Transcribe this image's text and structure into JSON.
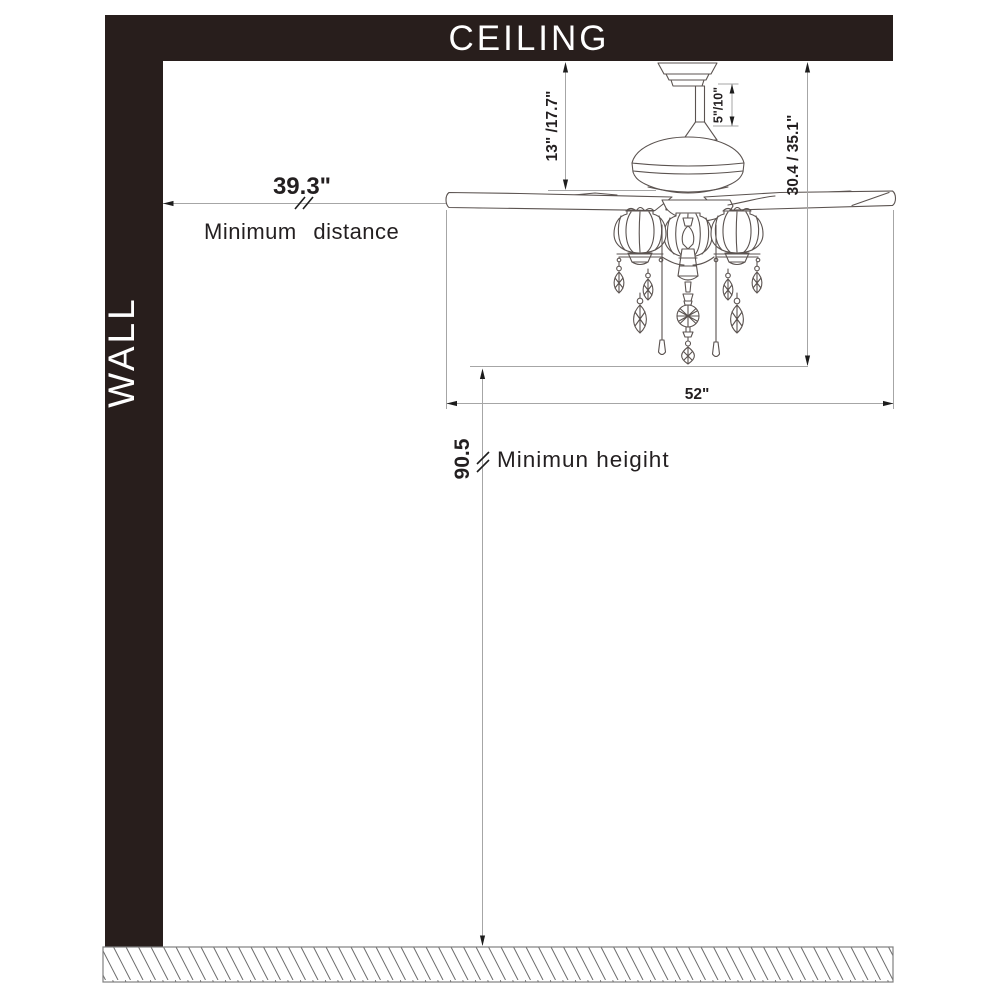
{
  "labels": {
    "ceiling": "CEILING",
    "wall": "WALL"
  },
  "dimensions": {
    "min_distance_value": "39.3\"",
    "min_distance_label": "Minimum distance",
    "ceiling_to_blade": "13\" /17.7\"",
    "downrod_length": "5\"/10\"",
    "ceiling_to_light_bottom": "30.4 / 35.1\"",
    "blade_sweep": "52\"",
    "min_height_value": "90.5",
    "min_height_label": "Minimun heigiht"
  },
  "colors": {
    "band": "#281e1c",
    "band_text": "#ffffff",
    "drawing_line": "#5b5350",
    "dimension_line": "#a6a6a6",
    "arrow": "#1d1d1d",
    "text": "#231f20"
  }
}
